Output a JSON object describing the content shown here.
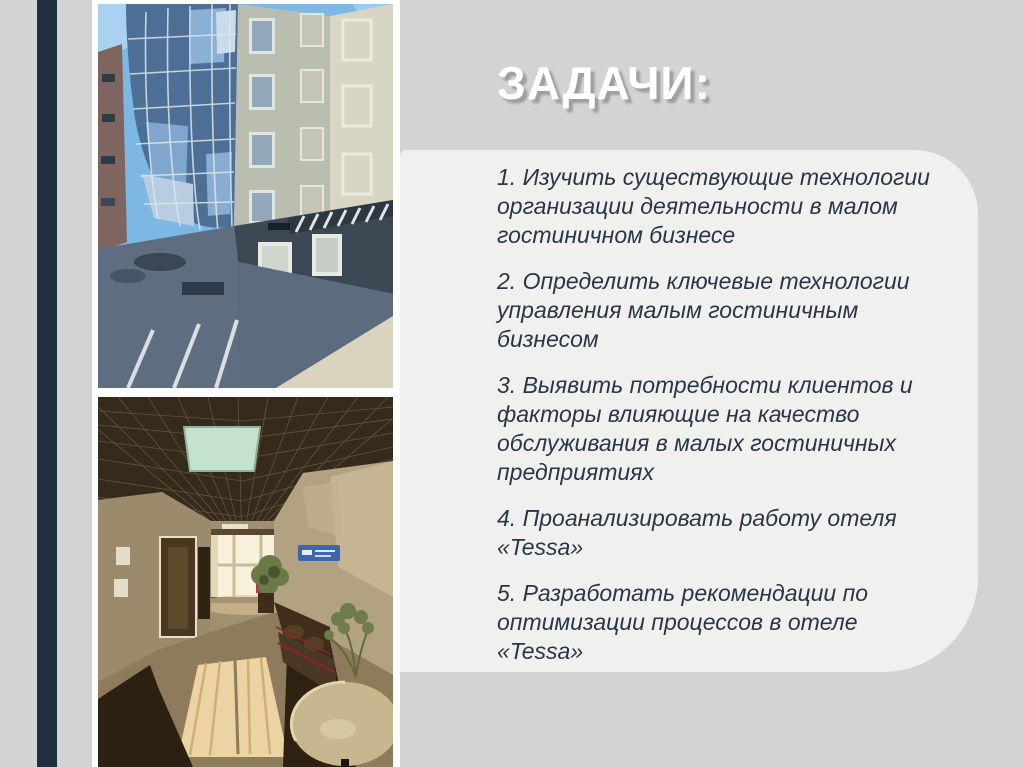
{
  "slide": {
    "title": "ЗАДАЧИ:",
    "tasks": [
      "1. Изучить существующие технологии организации деятельности в малом гостиничном бизнесе",
      "2. Определить ключевые технологии управления малым гостиничным бизнесом",
      "3. Выявить потребности клиентов и факторы влияющие на качество обслуживания в малых гостиничных предприятиях",
      "4. Проанализировать работу отеля «Tessa»",
      "5. Разработать рекомендации по оптимизации процессов в отеле «Tessa»"
    ],
    "colors": {
      "accent_bar": "#20303f",
      "page_gray": "#d2d4d3",
      "panel": "#f0f1ef",
      "left_background": "#fdfdfc",
      "title_text": "#ffffff",
      "title_shadow": "#9c9ea0",
      "body_text": "#2a3645"
    }
  }
}
